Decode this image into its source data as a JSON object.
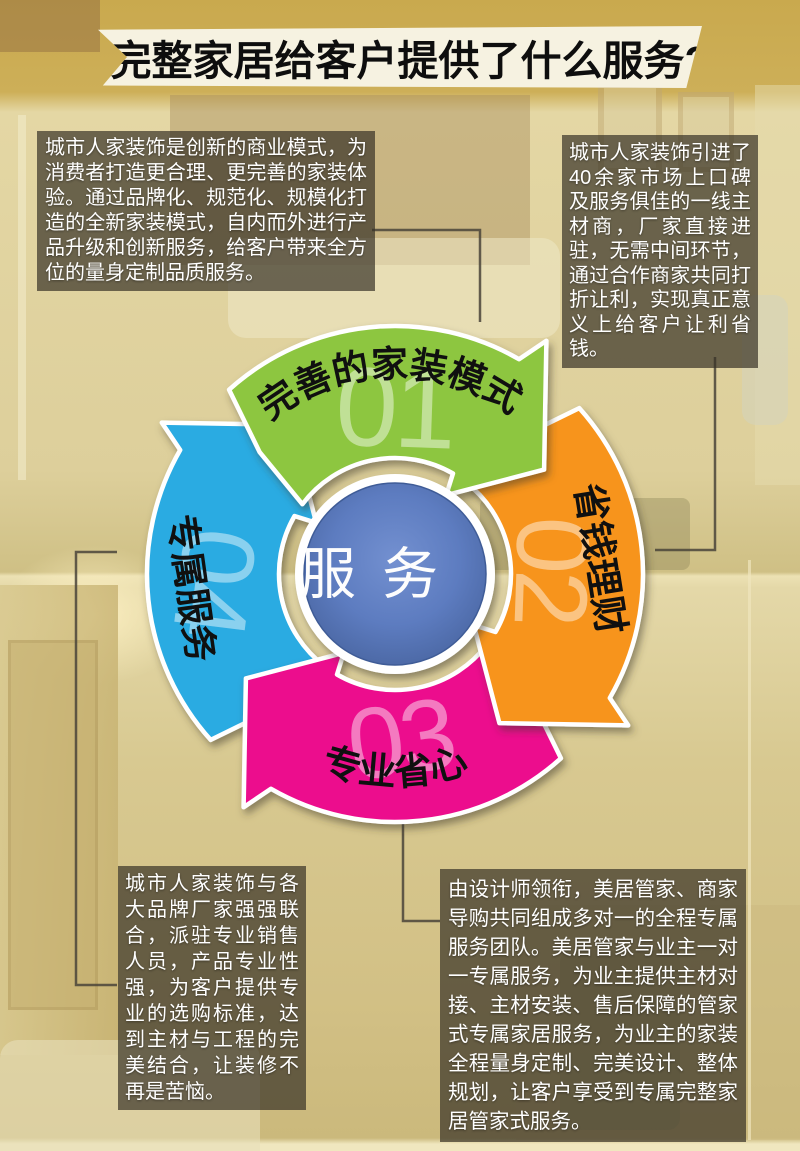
{
  "header": {
    "title": "完整家居给客户提供了什么服务?"
  },
  "blocks": {
    "top_left": {
      "text": "城市人家装饰是创新的商业模式，为消费者打造更合理、更完善的家装体验。通过品牌化、规范化、规模化打造的全新家装模式，自内而外进行产品升级和创新服务，给客户带来全方位的量身定制品质服务。"
    },
    "top_right": {
      "text": "城市人家装饰引进了40余家市场上口碑及服务俱佳的一线主材商，厂家直接进驻，无需中间环节，通过合作商家共同打折让利，实现真正意义上给客户让利省钱。"
    },
    "bottom_left": {
      "text": "城市人家装饰与各大品牌厂家强强联合，派驻专业销售人员，产品专业性强，为客户提供专业的选购标准，达到主材与工程的完美结合，让装修不再是苦恼。"
    },
    "bottom_right": {
      "text": "由设计师领衔，美居管家、商家导购共同组成多对一的全程专属服务团队。美居管家与业主一对一专属服务，为业主提供主材对接、主材安装、售后保障的管家式专属家居服务，为业主的家装全程量身定制、完美设计、整体规划，让客户享受到专属完整家居管家式服务。"
    }
  },
  "diagram": {
    "center_label": "服务",
    "center_color": "#5b7cc1",
    "number_color": "rgba(255,255,255,0.45)",
    "label_color": "#101010",
    "arrows": [
      {
        "id": "model",
        "number": "01",
        "label": "完善的家装模式",
        "color": "#8dc63f"
      },
      {
        "id": "save-money",
        "number": "02",
        "label": "省钱理财",
        "color": "#f7941e"
      },
      {
        "id": "worry-free",
        "number": "03",
        "label": "专业省心",
        "color": "#ec0f8d"
      },
      {
        "id": "exclusive",
        "number": "04",
        "label": "专属服务",
        "color": "#29abe2"
      }
    ]
  }
}
